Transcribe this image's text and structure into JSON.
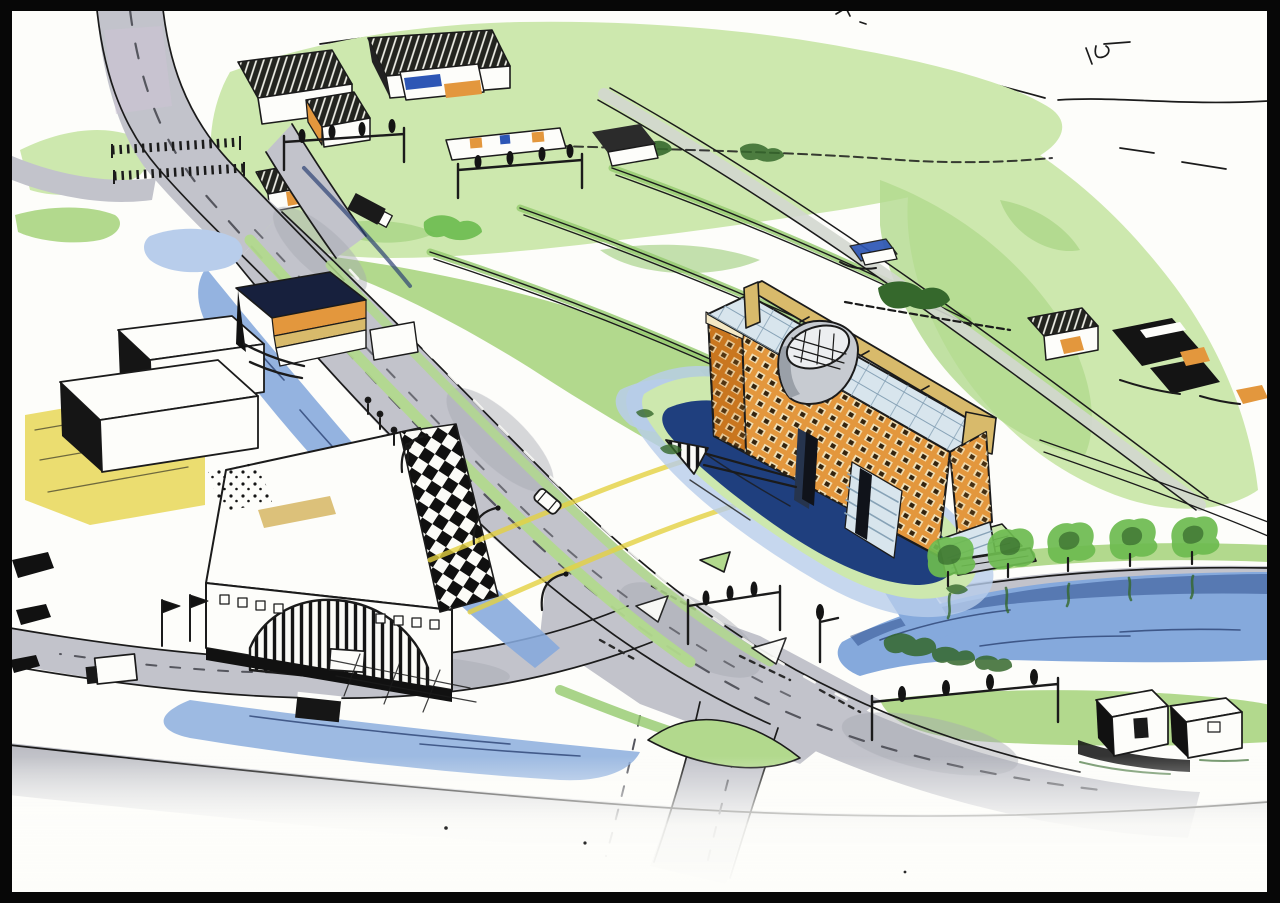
{
  "artwork": {
    "kind": "hand-drawn aerial perspective site sketch (ink and marker)",
    "description": "Aerial sketch: elongated orange office building with glazed atrium roof and tilted rooftop cone, standing in a water moat amid green polder fields; motorway with signalised intersection, canals lined with trees, industrial hall with arched entrance and checkerboard band, farm village at top, unfinished white paper at bottom, black scan border.",
    "visible_text": []
  },
  "palette": {
    "paper": "#fdfdfa",
    "ink": "#1b1b1b",
    "frame": "#070707",
    "grassLight": "#cde8ae",
    "grass": "#b2d98d",
    "grassDark": "#94c96d",
    "tree": "#6cbb4f",
    "treeDark": "#35682c",
    "waterLight": "#b8cdeb",
    "water": "#85a9dc",
    "waterDark": "#1f3f7e",
    "waterInk": "#2c4273",
    "road": "#c2c3cb",
    "roadDark": "#a6a7b1",
    "roadTint": "#cdc3d6",
    "orange": "#e3973d",
    "orangeDark": "#c9761f",
    "accentBlue": "#2d56b5",
    "navy": "#17203d",
    "tan": "#d8ba6b",
    "cream": "#f4e8c4",
    "yellow": "#e4d141",
    "glass": "#d8e5ed",
    "glassLine": "#87a2b6",
    "gray": "#c7cbd1"
  },
  "scene": {
    "focal_building": "orange slab building with window grid, glass roof, tan roof beam, gray cone, water moat, footbridge",
    "left_complex": "white industrial halls, arched striped entrance, checkerboard roof band, flags, trucks",
    "top": "farm village with hatched barn roofs and orange/blue facades",
    "infrastructure": "curving motorway with dashed lanes, traffic-light gantries, streetlights, bridges",
    "water": "canal along road, wide tree-lined canal to the right, pond, moat",
    "bottom": "sketch fades into blank paper"
  }
}
